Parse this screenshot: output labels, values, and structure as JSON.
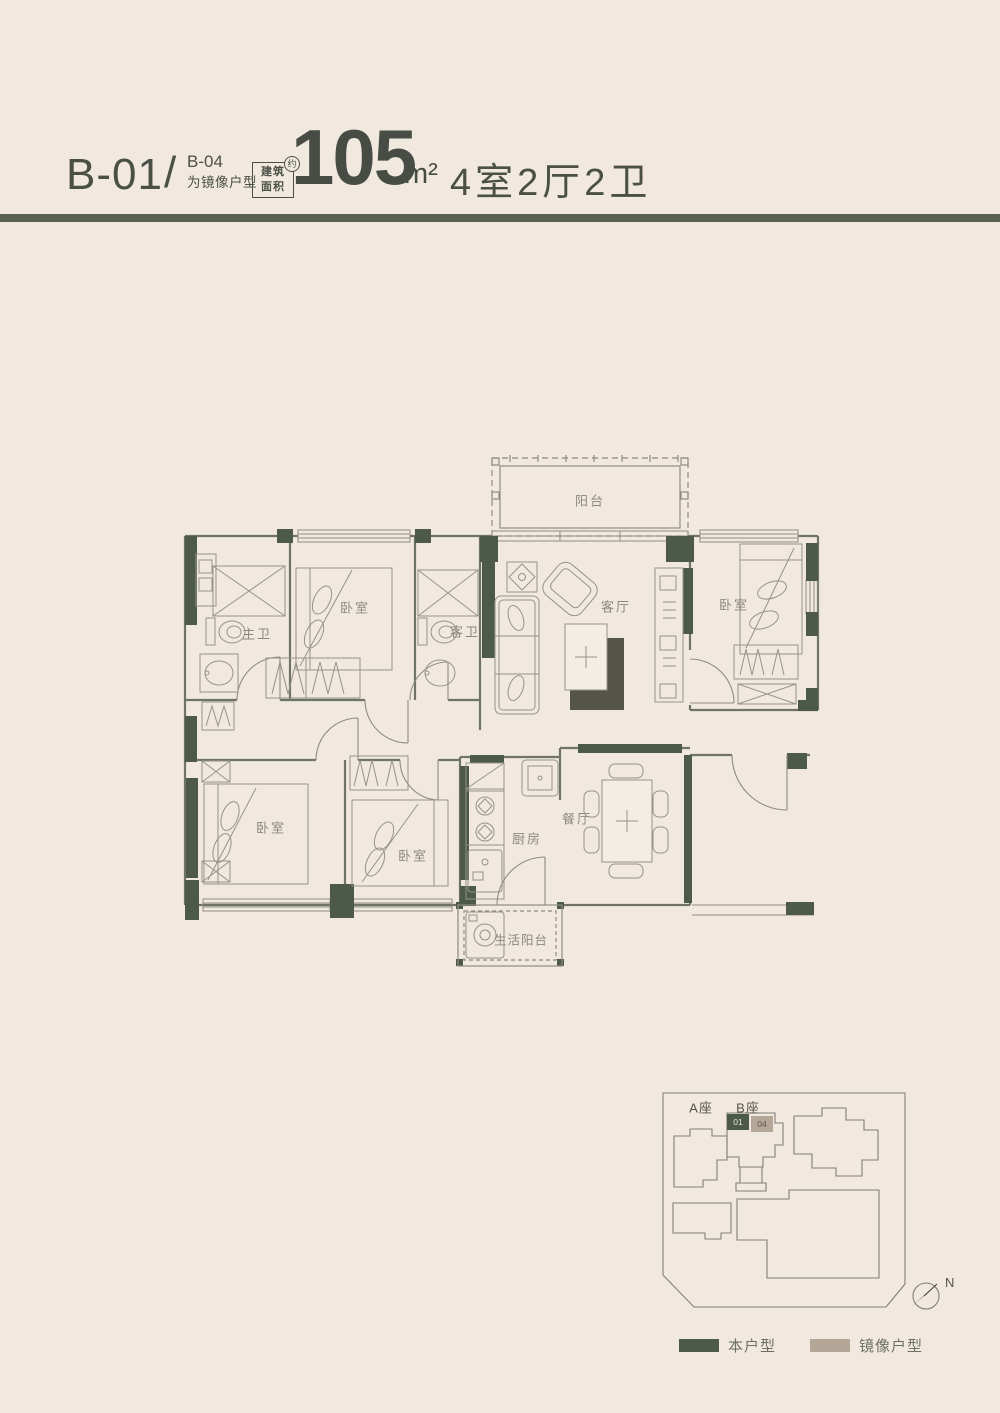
{
  "header": {
    "unit_code": "B-01",
    "slash": "/",
    "mirror_code": "B-04",
    "mirror_note": "为镜像户型",
    "area_tag_line1": "建筑",
    "area_tag_line2": "面积",
    "area_tag_approx": "约",
    "area_value": "105",
    "area_unit": "m²",
    "rooms_summary": "4室2厅2卫"
  },
  "floor_plan": {
    "rooms": [
      {
        "id": "balcony",
        "label": "阳台"
      },
      {
        "id": "living-room",
        "label": "客厅"
      },
      {
        "id": "bedroom-top-right",
        "label": "卧室"
      },
      {
        "id": "master-bathroom",
        "label": "主卫"
      },
      {
        "id": "bedroom-top-left",
        "label": "卧室"
      },
      {
        "id": "guest-bathroom",
        "label": "客卫"
      },
      {
        "id": "bedroom-bottom-left",
        "label": "卧室"
      },
      {
        "id": "bedroom-bottom-middle",
        "label": "卧室"
      },
      {
        "id": "kitchen",
        "label": "厨房"
      },
      {
        "id": "dining-room",
        "label": "餐厅"
      },
      {
        "id": "utility-balcony",
        "label": "生活阳台"
      }
    ]
  },
  "site_plan": {
    "tower_a": "A座",
    "tower_b": "B座",
    "unit_01": "01",
    "unit_04": "04",
    "north": "N"
  },
  "legend": {
    "this_unit": "本户型",
    "mirror_unit": "镜像户型"
  },
  "colors": {
    "background": "#f1e9e0",
    "accent_green": "#4d5949",
    "accent_tan": "#b4a797",
    "divider_bar": "#59614e",
    "line_gray": "#8e8c81"
  }
}
